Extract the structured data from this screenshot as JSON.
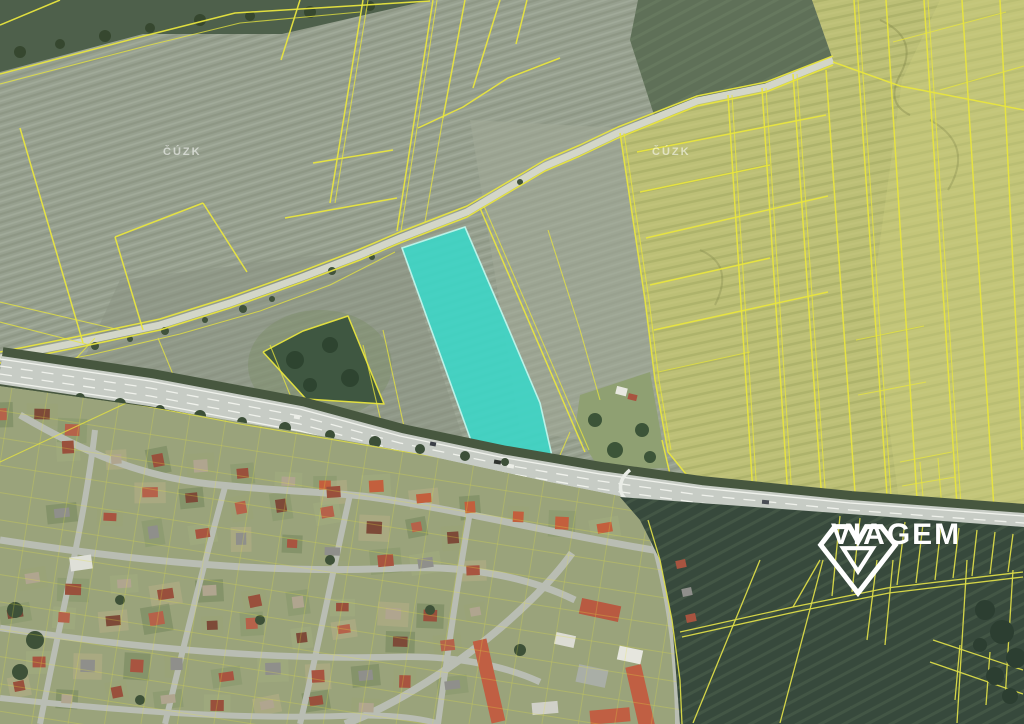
{
  "map": {
    "description": "aerial cadastral map with one parcel highlighted",
    "watermarks": {
      "provider": "ČÚZK"
    },
    "highlighted_parcel": {
      "shape": "elongated strip north of highway",
      "color_name": "turquoise"
    }
  },
  "brand": {
    "name": "VIAGEM",
    "icon": "viagem-gem-icon",
    "color": "#ffffff"
  },
  "colors": {
    "cadastral_line": "#e8e53e",
    "cadastral_line_dark": "#dcdc48",
    "highlight_parcel_fill": "#3ed5c5",
    "highlight_parcel_stroke": "#b9f2e8",
    "field_gray_green": "#97a08f",
    "field_rapeseed": "#bcbf76",
    "field_dark_green": "#37493c",
    "road_surface": "#c7ccc5",
    "watermark_text": "#ffffff"
  }
}
